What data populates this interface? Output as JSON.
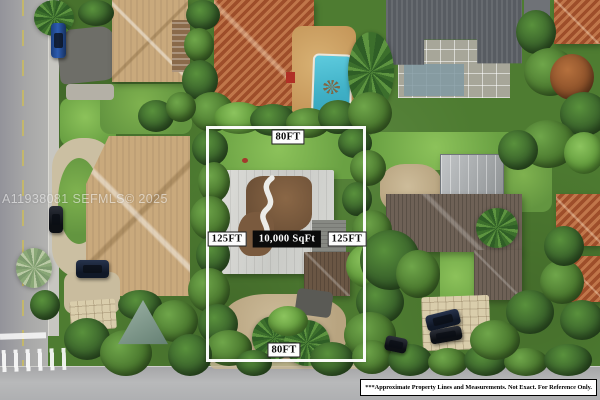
{
  "listing_overlay": {
    "top_dimension": "80FT",
    "bottom_dimension": "80FT",
    "left_dimension": "125FT",
    "right_dimension": "125FT",
    "area_label": "10,000 SqFt",
    "outline_color": "#ffffff",
    "area_chip_bg": "#0b0b0b",
    "area_chip_text": "#ffffff"
  },
  "watermark": "A11938081 SEFMLS© 2025",
  "disclaimer": "***Approximate Property Lines and Measurements. Not Exact. For Reference Only.",
  "scene": {
    "description": "Aerial drone photo of a residential lot outlined in white (80FT x 125FT, 10,000 SqFt) surrounded by neighboring homes, pools, palm trees and streets",
    "colors": {
      "vegetation": "#4e7c31",
      "street": "#a7a7a7",
      "pool_water": "#4cc2d6",
      "terracotta_roof": "#b5613a",
      "tan_roof": "#c9a97c",
      "dark_gray_roof": "#585c62",
      "subject_roof_silver": "#d3d4d0",
      "subject_roof_patch": "#7c5a3c",
      "neighbor_brown_roof": "#6e6156",
      "sand": "#c2ae8a"
    }
  }
}
